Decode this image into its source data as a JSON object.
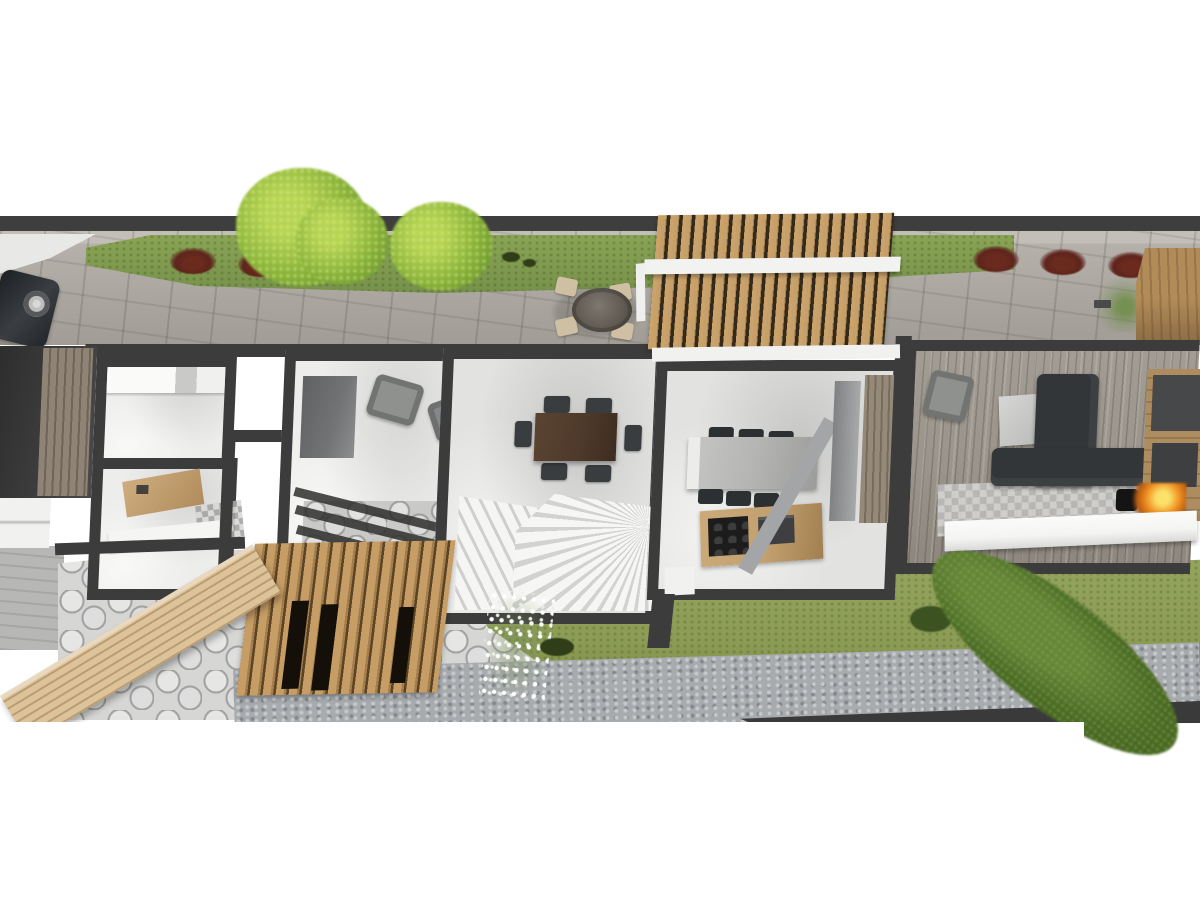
{
  "title": "3D top-view floor plan render of a duplex house",
  "palette": {
    "white": "#ffffff",
    "wall": "#3c3c3c",
    "road": "#3e3e3e",
    "paving": "#b2aea7",
    "pavingdark": "#9d9992",
    "lawn": "#7f9a4c",
    "lawnyard": "#8c9c55",
    "treelight": "#b6d453",
    "treemid": "#8ab33a",
    "treedark": "#44611f",
    "bushred": "#5d241c",
    "woodslat": "#c5a06b",
    "woodgap": "#332a1b",
    "wooddeck": "#d2b78d",
    "woodcounter": "#c2a06f",
    "floorwhite": "#ededeb",
    "floorsoft": "#e2e2e0",
    "stair": "#f5f5f3",
    "stairshadow": "#cfcfcd",
    "island": "#b5b5b3",
    "furndark": "#2d3032",
    "tablebrown": "#4f3a2b",
    "chairbeige": "#cfc0a4",
    "sofadark": "#333638",
    "plank": "#9a948b",
    "mediawood": "#a98a5e",
    "paneldark": "#46484a",
    "fire": "#ef8c1e",
    "fireglow": "#fbe06a",
    "flagstone": "#d6d6d4",
    "gravel": "#a7abae",
    "bench": "#f4f4f2",
    "car": "#25282b",
    "graypanel": "#717375"
  },
  "scene": {
    "type": "architectural-3d-floorplan",
    "view": "top-down",
    "areas": [
      {
        "name": "street-front",
        "items": [
          "dark-road-edge",
          "paver-sidewalk",
          "lawn-strip",
          "red-bushes-x6",
          "bright-green-trees-x3",
          "round-outdoor-table-with-4-beige-chairs",
          "parked-car",
          "white-driveway",
          "small-plant-with-planter",
          "wood-deck-corner"
        ]
      },
      {
        "name": "front-pergola",
        "items": [
          "vertical-wood-slats",
          "white-cross-beam",
          "white-post",
          "white-fascia"
        ]
      },
      {
        "name": "unit-left-rooms",
        "items": [
          {
            "room": "garage-dark-slab",
            "furniture": [
              "wood-door-strip",
              "white-slabs"
            ]
          },
          {
            "room": "utility-room",
            "furniture": [
              "white-counter-run"
            ]
          },
          {
            "room": "bathroom",
            "furniture": [
              "wood-vanity",
              "sink",
              "mosaic-tile-patch",
              "white-counter"
            ]
          },
          {
            "room": "entry-terrace",
            "furniture": [
              "gray-wall-panel",
              "armchair",
              "armchair",
              "stone-floor-strip",
              "beam-shadows-x3"
            ]
          },
          {
            "room": "dining-stair-hall",
            "furniture": [
              "dark-brown-dining-table",
              "dining-chairs-x6",
              "u-shaped-staircase"
            ]
          },
          {
            "room": "kitchen",
            "furniture": [
              "gray-island",
              "bar-stools-x6",
              "wood-counter",
              "black-cooktop",
              "oven",
              "fridge",
              "gray-partition",
              "diagonal-beam",
              "wood-floor-strip"
            ]
          }
        ]
      },
      {
        "name": "unit-right-rooms",
        "items": [
          {
            "room": "living-room",
            "furniture": [
              "gray-armchair",
              "coffee-table",
              "l-shaped-charcoal-sofa",
              "wood-media-wall",
              "dark-tv-panels-x2",
              "fireplace-with-flame",
              "checkered-rug",
              "white-bench-cabinet"
            ]
          }
        ]
      },
      {
        "name": "backyard",
        "items": [
          "flagstone-patio",
          "slatted-wood-canopy",
          "diagonal-deck-board",
          "lawn",
          "white-flower-shrub",
          "dark-green-tufts",
          "gravel-path",
          "dark-edge-wedge",
          "large-dark-green-tree"
        ]
      }
    ]
  }
}
